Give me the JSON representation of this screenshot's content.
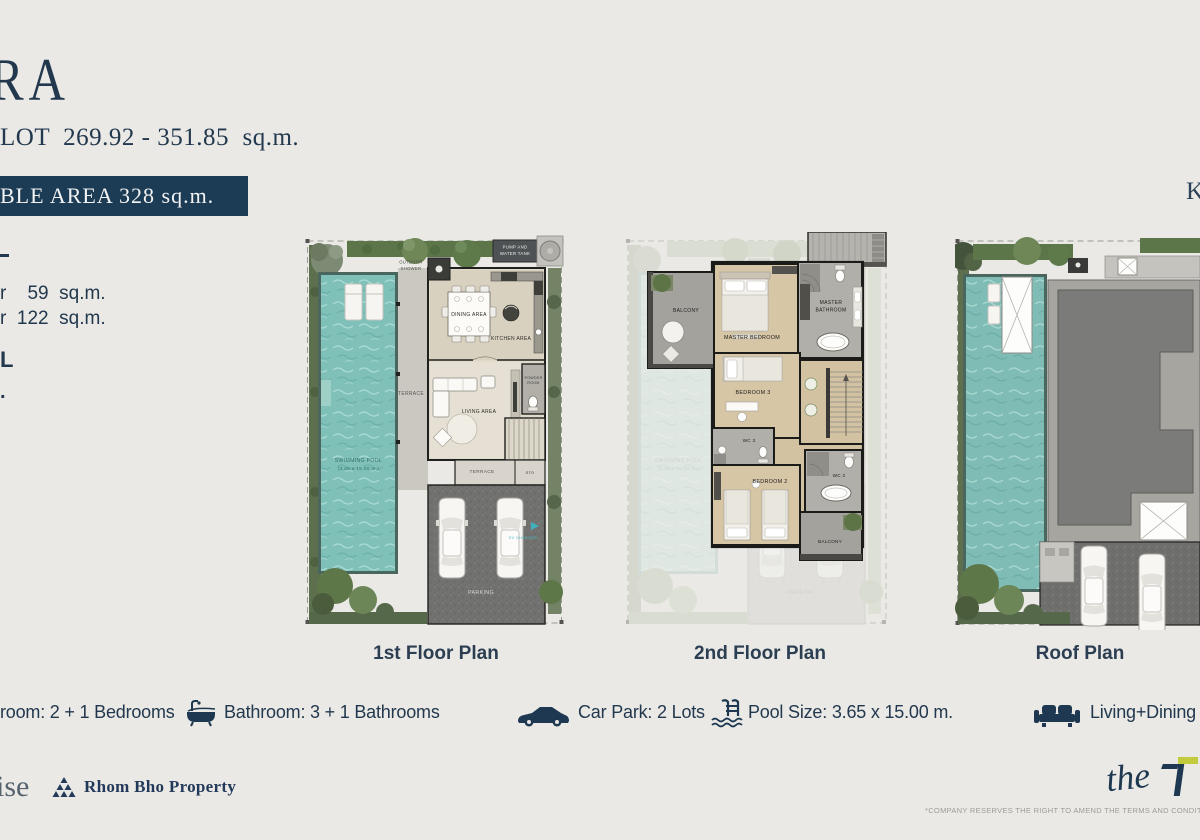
{
  "header": {
    "title_fragment": "RA",
    "lot_line": "LOT  269.92 - 351.85  sq.m.",
    "usable_area_banner": "BLE AREA 328 sq.m.",
    "key_plan_fragment": "K"
  },
  "left_fragments": {
    "area_line_1": "r    59  sq.m.",
    "area_line_2": "r  122  sq.m.",
    "letter": "L",
    "dot": "."
  },
  "plans": {
    "first": {
      "caption": "1st Floor Plan",
      "labels": {
        "pump_1": "PUMP AND",
        "pump_2": "WATER TANK",
        "outdoor_1": "OUTDOOR",
        "outdoor_2": "SHOWER",
        "dining": "DINING AREA",
        "kitchen": "KITCHEN AREA",
        "terrace_side": "TERRACE",
        "living": "LIVING AREA",
        "powder_1": "POWDER",
        "powder_2": "ROOM",
        "terrace_front": "TERRACE",
        "sto": "STO",
        "pool_1": "SWIMMING POOL",
        "pool_2": "(3.65 x 15.00 m.)",
        "ev_charger": "EV CHARGER",
        "parking": "PARKING"
      }
    },
    "second": {
      "caption": "2nd Floor Plan",
      "labels": {
        "balcony_top": "BALCONY",
        "master_bedroom": "MASTER BEDROOM",
        "master_bath_1": "MASTER",
        "master_bath_2": "BATHROOM",
        "bedroom3": "BEDROOM 3",
        "wc3": "WC 3",
        "bedroom2": "BEDROOM 2",
        "wc2": "WC 2",
        "balcony_bottom": "BALCONY",
        "pool_ghost_1": "SWIMMING POOL",
        "pool_ghost_2": "(3.65 x 15.00 m.)",
        "parking_ghost": "PARKING"
      }
    },
    "roof": {
      "caption": "Roof Plan"
    }
  },
  "features": [
    {
      "name": "bedrooms",
      "label": "room: 2 + 1 Bedrooms"
    },
    {
      "name": "bathrooms",
      "label": "Bathroom: 3 + 1 Bathrooms"
    },
    {
      "name": "car-park",
      "label": "Car Park: 2 Lots"
    },
    {
      "name": "pool-size",
      "label": "Pool Size: 3.65 x 15.00 m."
    },
    {
      "name": "living-dining",
      "label": "Living+Dining"
    }
  ],
  "footer": {
    "partner_logo_fragment": "ise",
    "developer_name": "Rhom Bho Property",
    "brand_script": "the",
    "disclaimer": "*COMPANY RESERVES THE RIGHT TO AMEND THE TERMS AND CONDITIONS, AT ANY"
  },
  "colors": {
    "accent_navy": "#1c3b55",
    "pool_teal": "#7fc0b9",
    "brand_yellow": "#c2ca3e"
  }
}
